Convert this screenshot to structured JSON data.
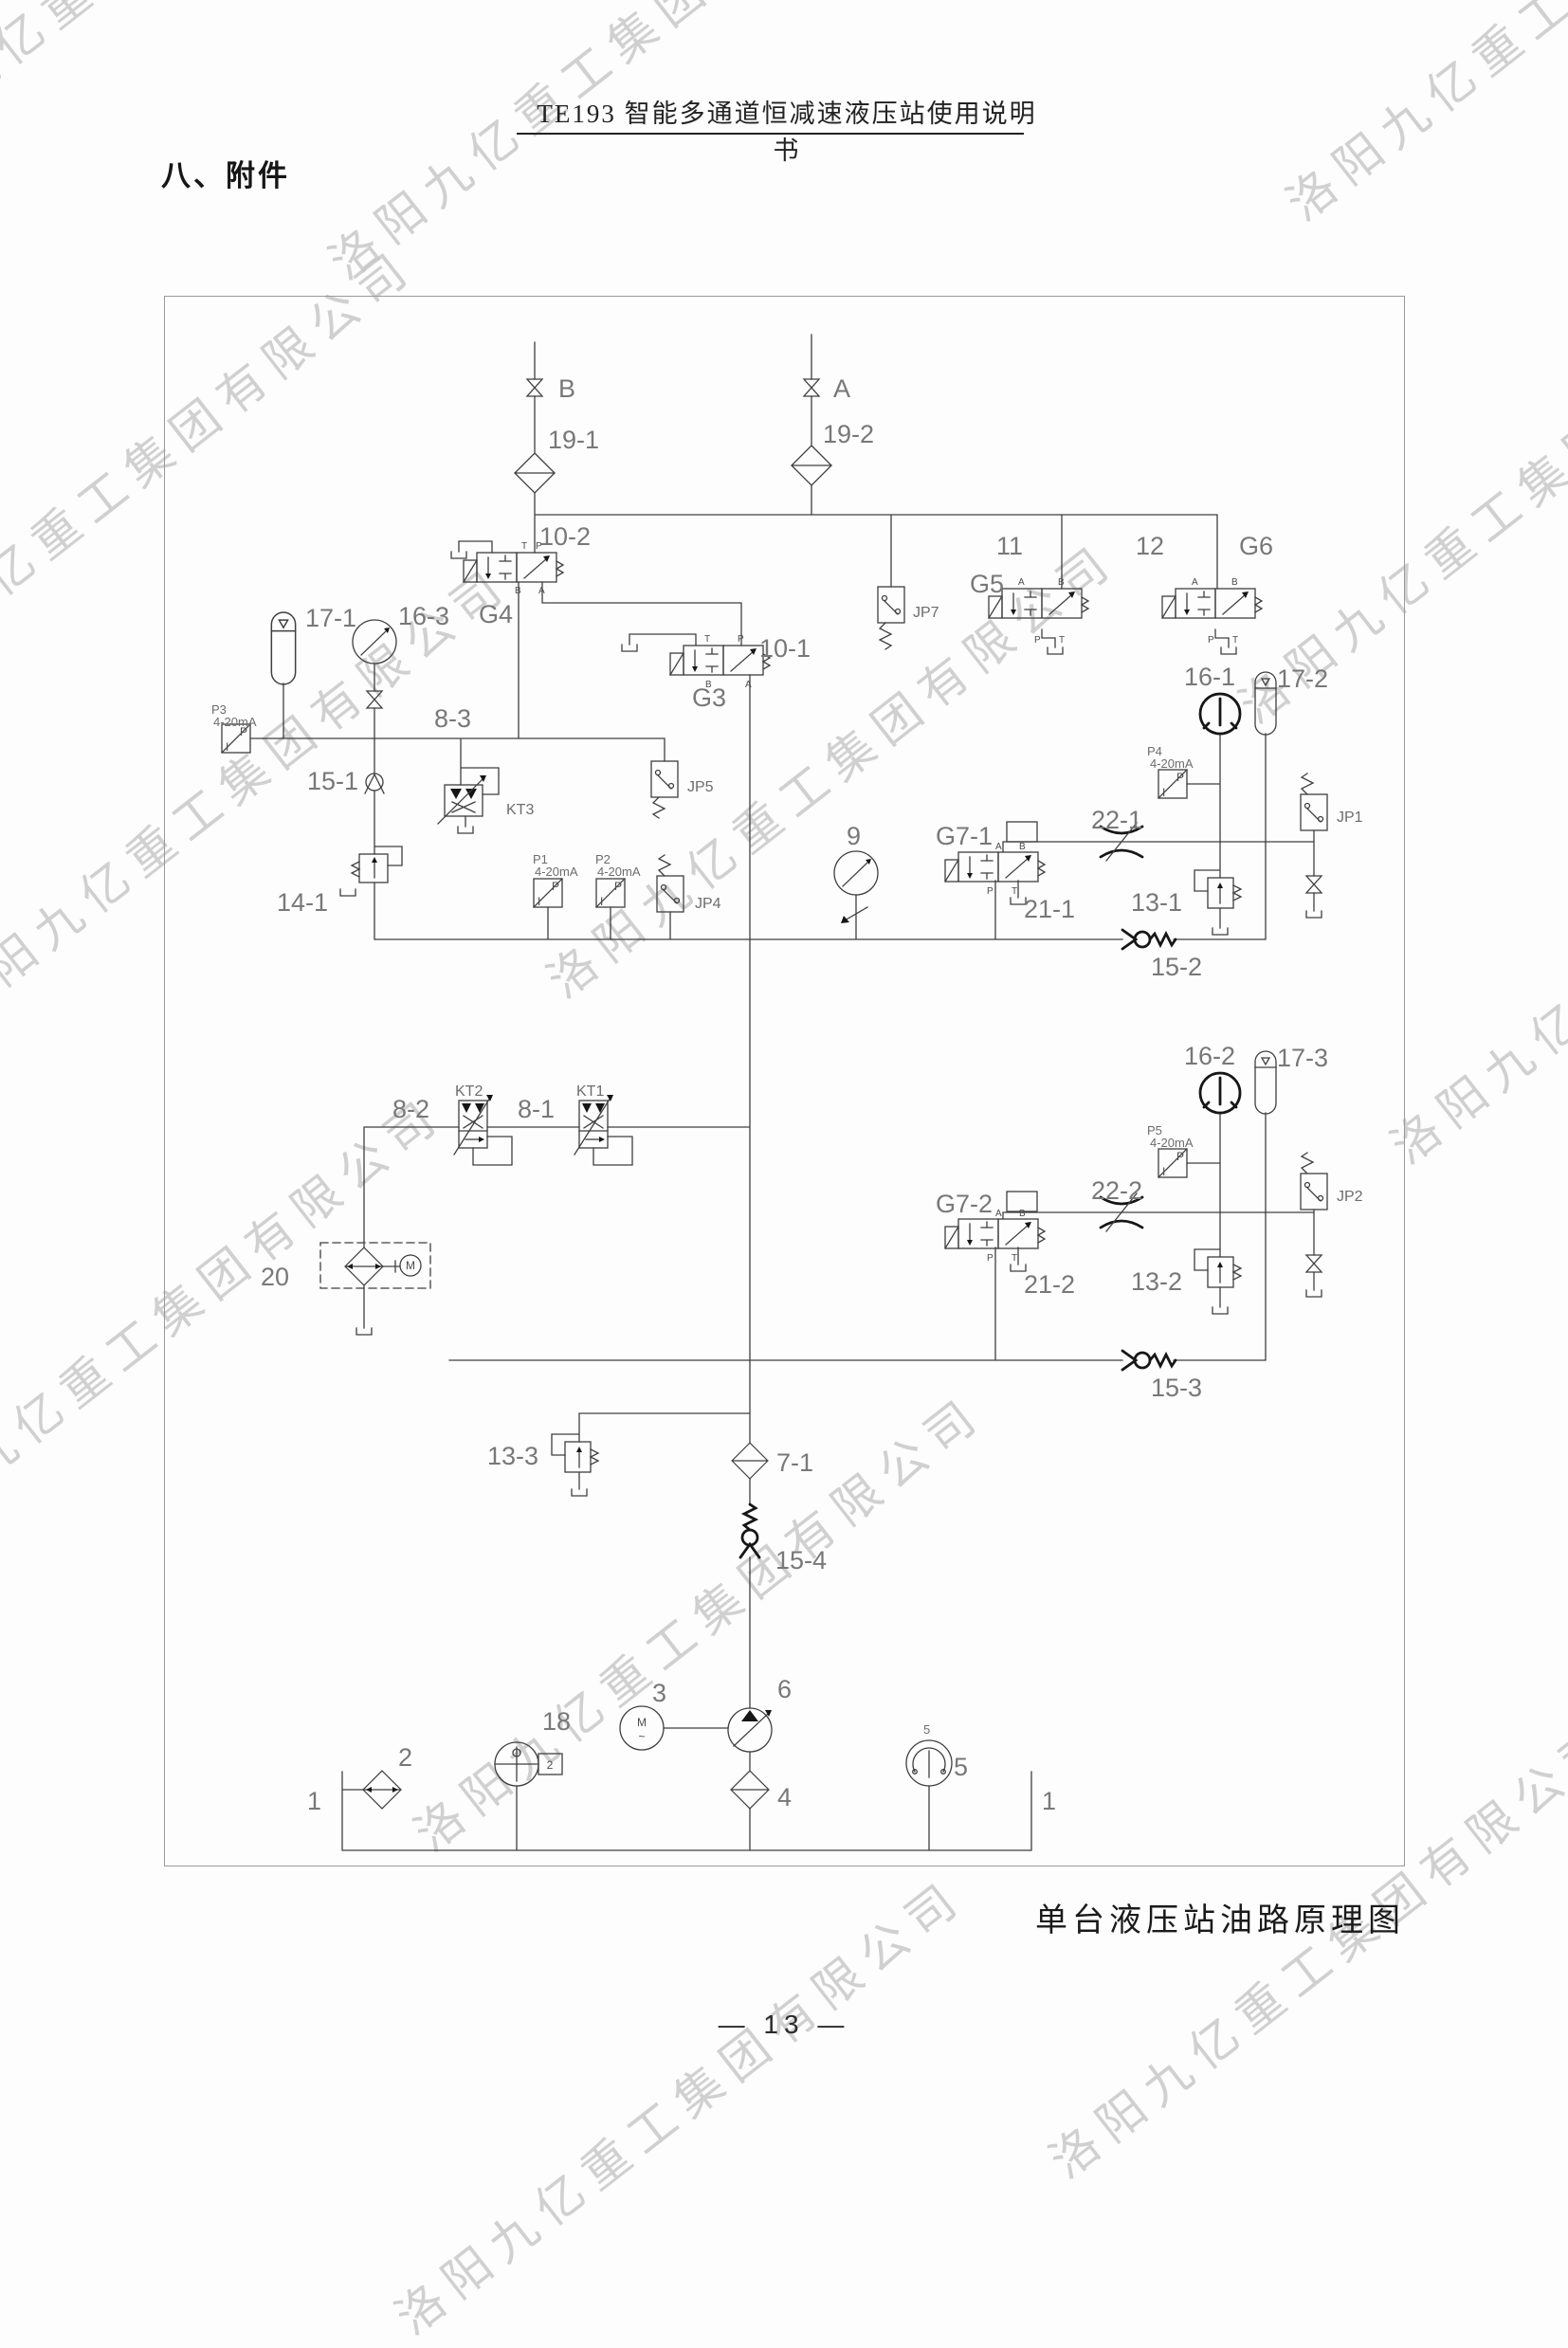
{
  "header": {
    "title": "TE193 智能多通道恒减速液压站使用说明书"
  },
  "section_title": "八、附件",
  "caption": "单台液压站油路原理图",
  "page_number": "— 13 —",
  "watermark": {
    "text": "洛阳九亿重工集团有限公司"
  },
  "diagram": {
    "ports": {
      "a": "A",
      "b": "B",
      "p": "P",
      "t": "T"
    },
    "transmitter": {
      "p": "P",
      "i": "I",
      "range": "4-20mA"
    },
    "motor": {
      "m": "M",
      "ac": "~"
    },
    "labels": {
      "b": "B",
      "a": "A",
      "f19_1": "19-1",
      "f19_2": "19-2",
      "v10_2": "10-2",
      "g4": "G4",
      "v10_1": "10-1",
      "g3": "G3",
      "v11": "11",
      "g5": "G5",
      "v12": "12",
      "g6": "G6",
      "jp7": "JP7",
      "acc17_1": "17-1",
      "gauge16_3": "16-3",
      "v8_3": "8-3",
      "p3": "P3",
      "ck15_1": "15-1",
      "kt3": "KT3",
      "v14_1": "14-1",
      "p1": "P1",
      "p2": "P2",
      "jp4": "JP4",
      "jp5": "JP5",
      "gauge9": "9",
      "g7_1": "G7-1",
      "v21_1": "21-1",
      "o22_1": "22-1",
      "gauge16_1": "16-1",
      "acc17_2": "17-2",
      "p4": "P4",
      "jp1": "JP1",
      "v13_1": "13-1",
      "ck15_2": "15-2",
      "gauge16_2": "16-2",
      "acc17_3": "17-3",
      "p5": "P5",
      "jp2": "JP2",
      "o22_2": "22-2",
      "g7_2": "G7-2",
      "v21_2": "21-2",
      "v13_2": "13-2",
      "ck15_3": "15-3",
      "v8_2": "8-2",
      "kt2": "KT2",
      "v8_1": "8-1",
      "kt1": "KT1",
      "u20": "20",
      "v13_3": "13-3",
      "f7_1": "7-1",
      "ck15_4": "15-4",
      "n2": "2",
      "n18": "18",
      "n3": "3",
      "n6": "6",
      "n4": "4",
      "n5": "5",
      "n1": "1",
      "level_box": "2"
    }
  }
}
